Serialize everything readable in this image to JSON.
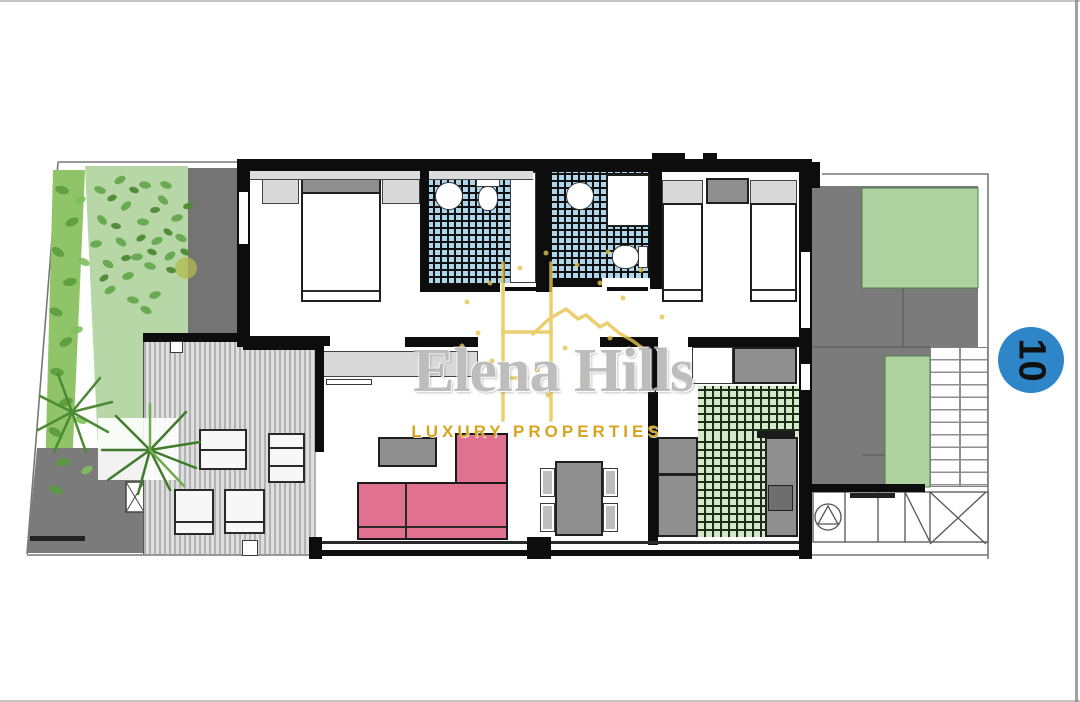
{
  "watermark": {
    "title": "Elena Hills",
    "subtitle": "LUXURY PROPERTIES",
    "logo": "house-monogram-icon"
  },
  "plot_badge": {
    "number": "10"
  },
  "palette": {
    "wall": "#0d0d0d",
    "garden-green": "#b7d7a6",
    "hedge-green": "#8fc468",
    "tile-blue": "#aed6ea",
    "tile-green": "#d4e8cc",
    "sofa-pink": "#e07190",
    "furniture-gray": "#8f8f8f",
    "light-gray": "#d9d9d9",
    "paving-gray": "#7b7b7b",
    "badge-blue": "#2e86c9",
    "gold": "#e6c44d",
    "watermark-gold": "#d7a41f"
  }
}
